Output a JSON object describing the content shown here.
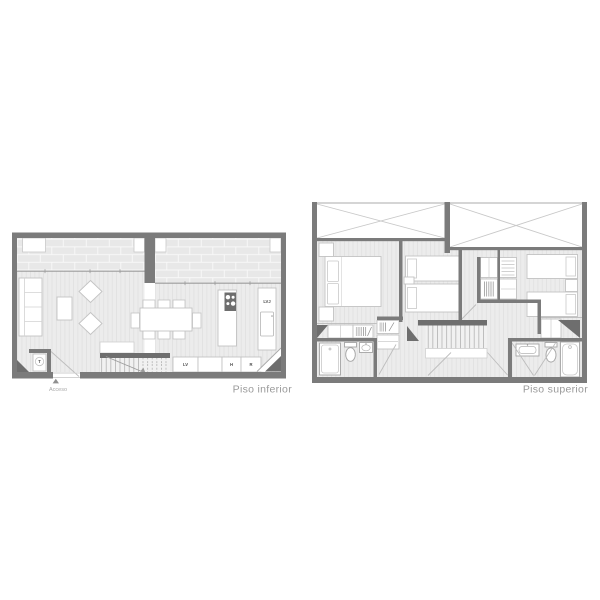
{
  "canvas": {
    "width": 600,
    "height": 600,
    "background": "#ffffff"
  },
  "colors": {
    "wall": "#7b7b7b",
    "wall_dark": "#6e6e6e",
    "floor": "#ececec",
    "floor_stripe": "#e0e0e0",
    "terrace": "#e8e8e8",
    "terrace_joint": "#f8f8f8",
    "furniture_outline": "#c3c3c3",
    "fixture_outline": "#a5a5a5",
    "void_cross": "#c8c8c8",
    "door_swing": "#bdbdbd",
    "title_text": "#9a9a9a",
    "small_label_text": "#4d4d4d"
  },
  "plans": {
    "lower": {
      "title": "Piso inferior",
      "access_label": "Acceso",
      "labels": {
        "lvj": "LVJ",
        "lv": "LV",
        "h": "H",
        "r": "R",
        "t": "T"
      }
    },
    "upper": {
      "title": "Piso superior"
    }
  }
}
